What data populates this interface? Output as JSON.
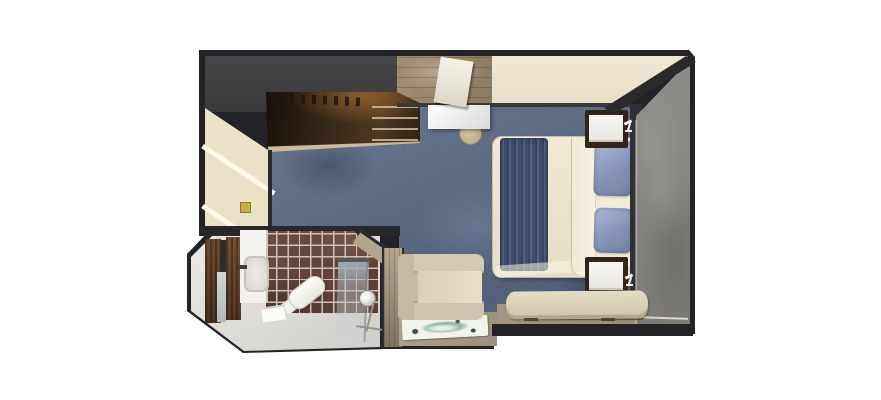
{
  "scene": {
    "kind": "cruise-stateroom-floorplan",
    "orientation": "top-down 3D render",
    "visible_text": "none"
  },
  "rooms": {
    "main_cabin": "main cabin with queen bed, desk, armchair and bench",
    "bathroom": "bathroom with vanity sink, toilet and glass shower",
    "entry_vestibule": "entry vestibule with open wood door",
    "closet": "open wardrobe closet with hangers and shelves"
  },
  "furniture": {
    "bed": "queen bed",
    "bed_runner": "navy ribbed bed runner",
    "bed_sheet": "folded sheet band",
    "pillows": "two periwinkle pillows with two white pillows",
    "nightstand_top": "nightstand with reading light",
    "nightstand_bottom": "nightstand with reading light",
    "desk": "white desk",
    "stool": "round stool",
    "luggage_rack": "luggage bench",
    "armchair": "beige armchair",
    "bench": "foot-of-bed bench",
    "rug": "teal floral accent rug",
    "vanity": "bathroom vanity with sink and faucet",
    "toilet": "toilet",
    "shower": "glass shower with chrome shower head",
    "towel": "folded towel",
    "entry_door": "open wood entry door with mirror",
    "tile_wall": "brown mosaic tile wall"
  },
  "icons": {
    "lamp_top": "reading-lamp-icon",
    "lamp_bottom": "reading-lamp-icon"
  },
  "palette": {
    "wall": "#232327",
    "charcoal_band": "#39393c",
    "carpet_blue": "#5a6780",
    "cream_headwall": "#ebe3cf",
    "wood_floor": "#97856b",
    "closet_brown": "#3a2a1a",
    "gray_right_wall": "#868583",
    "duvet_cream": "#ece4cf",
    "runner_navy": "#46536f",
    "pillow_periwinkle": "#93a1c3",
    "furniture_beige": "#d2c8b1",
    "tile_brown": "#64463f",
    "grout": "#cec2b8",
    "bath_floor": "#e2e0dc",
    "tan_floor": "#a2967f",
    "rug_teal": "#8fb5a9",
    "switch_yellow": "#c8b23e"
  }
}
